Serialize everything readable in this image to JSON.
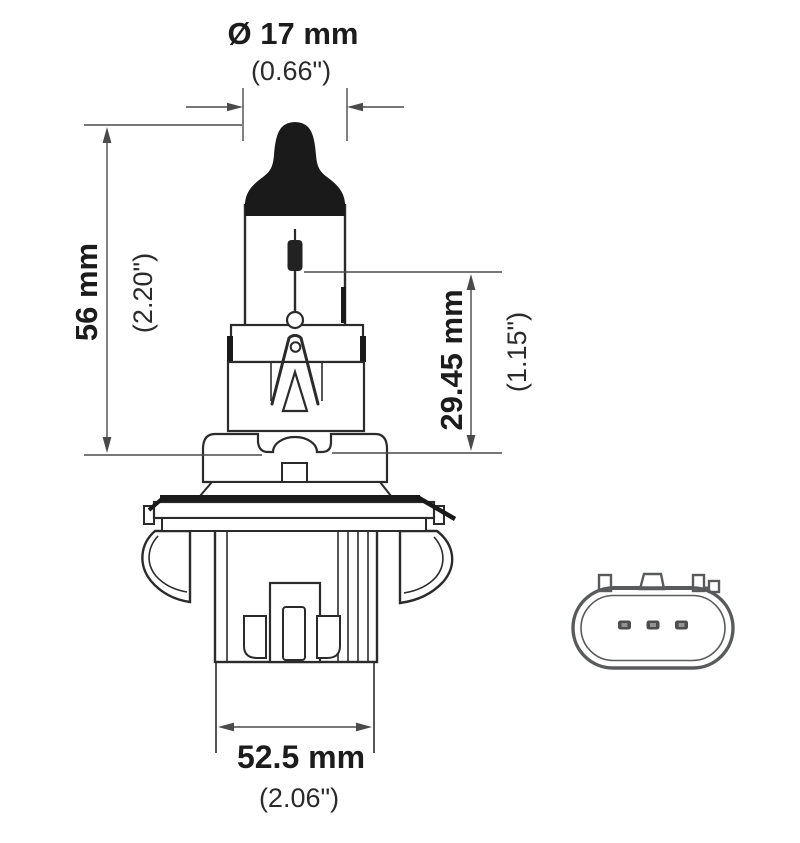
{
  "dimensions": {
    "bulb_diameter": {
      "metric": "Ø 17 mm",
      "imperial": "(0.66\")"
    },
    "overall_length": {
      "metric": "56 mm",
      "imperial": "(2.20\")"
    },
    "light_center_length": {
      "metric": "29.45 mm",
      "imperial": "(1.15\")"
    },
    "base_width": {
      "metric": "52.5 mm",
      "imperial": "(2.06\")"
    }
  },
  "colors": {
    "line": "#2b2b2b",
    "dimension_line": "#4a4a4a",
    "text": "#1c1c1c",
    "connector_line": "#595a5c",
    "background": "#ffffff"
  }
}
